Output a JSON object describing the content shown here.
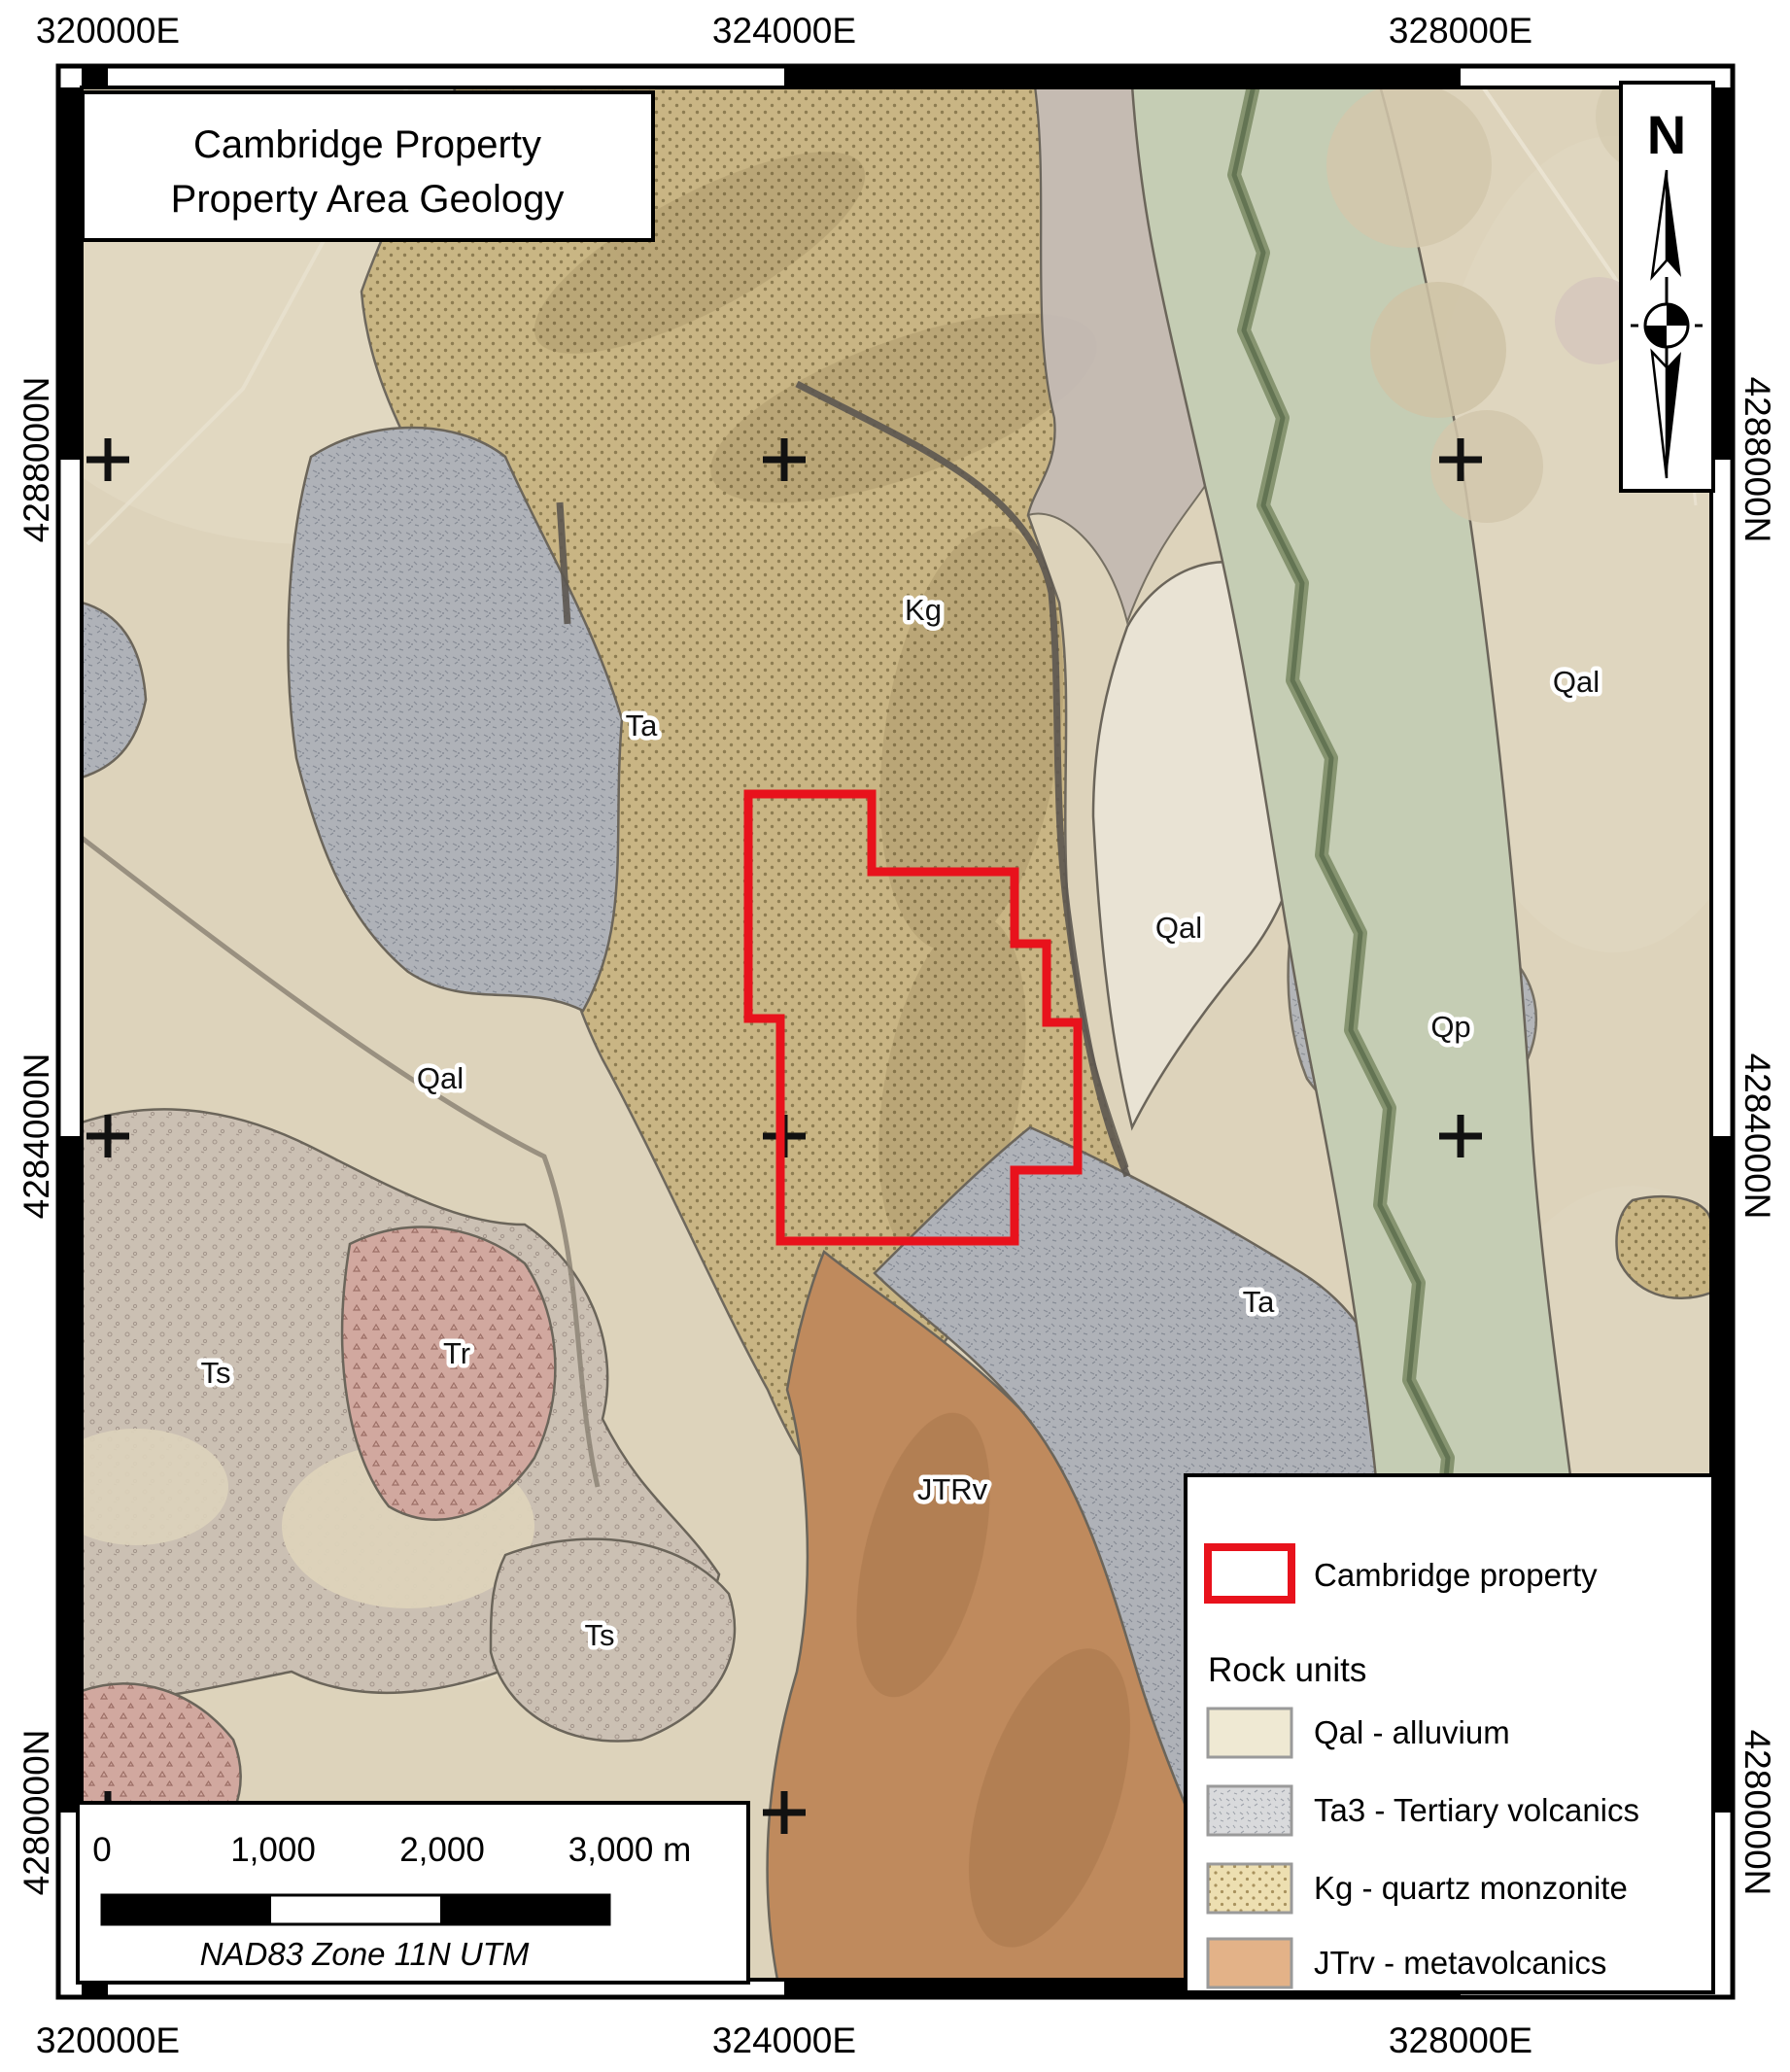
{
  "title": {
    "line1": "Cambridge Property",
    "line2": "Property Area Geology"
  },
  "compass": {
    "label": "N"
  },
  "grid": {
    "eastings": [
      {
        "label": "320000E"
      },
      {
        "label": "324000E"
      },
      {
        "label": "328000E"
      }
    ],
    "northings": [
      {
        "label": "4288000N"
      },
      {
        "label": "4284000N"
      },
      {
        "label": "4280000N"
      }
    ]
  },
  "map_labels": [
    {
      "text": "Kg"
    },
    {
      "text": "Ta"
    },
    {
      "text": "Qal"
    },
    {
      "text": "Qal"
    },
    {
      "text": "Qp"
    },
    {
      "text": "Qal"
    },
    {
      "text": "Ta"
    },
    {
      "text": "Tr"
    },
    {
      "text": "Ts"
    },
    {
      "text": "Ts"
    },
    {
      "text": "JTRv"
    }
  ],
  "legend": {
    "property_label": "Cambridge property",
    "rock_units_heading": "Rock units",
    "items": [
      {
        "code": "Qal",
        "label": "Qal - alluvium",
        "color": "#efe9d3"
      },
      {
        "code": "Ta3",
        "label": "Ta3 - Tertiary volcanics",
        "color": "#d9dadc"
      },
      {
        "code": "Kg",
        "label": "Kg - quartz monzonite",
        "color": "#eddfb1"
      },
      {
        "code": "JTrv",
        "label": "JTrv - metavolcanics",
        "color": "#e3b288"
      }
    ]
  },
  "scalebar": {
    "ticks": [
      "0",
      "1,000",
      "2,000",
      "3,000 m"
    ],
    "datum": "NAD83 Zone 11N UTM"
  },
  "colors": {
    "property_outline": "#e8121c",
    "qal_alluvium": "#ddd3bb",
    "kg_quartz_monzonite": "#c9b583",
    "ta_tertiary_volcanics": "#aeb1b7",
    "jtrv_metavolcanics": "#bf8a5d",
    "tr_unit": "#d1a89f",
    "ts_unit": "#cbc0b3",
    "riparian_corridor": "#c5cdb4"
  }
}
